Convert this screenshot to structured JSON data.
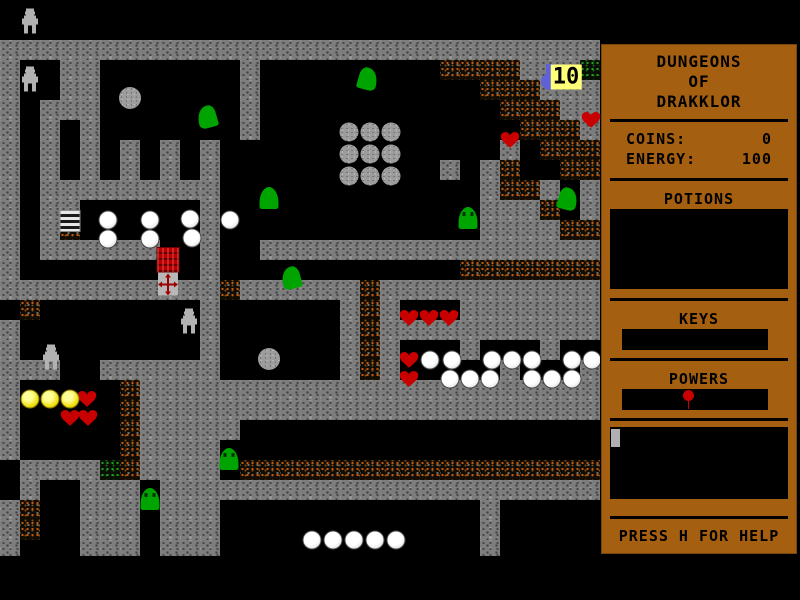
{
  "sidebar": {
    "title_lines": [
      "DUNGEONS",
      "OF",
      "DRAKKLOR"
    ],
    "coins_label": "COINS:",
    "coins_value": "0",
    "energy_label": "ENERGY:",
    "energy_value": "100",
    "potions_label": "POTIONS",
    "keys_label": "KEYS",
    "powers_label": "POWERS",
    "powers_items": [
      "red-pin"
    ],
    "help_text": "PRESS H FOR HELP"
  },
  "palette": {
    "panel_brown": "#a55f10",
    "wall_gray": "#7d7d7d",
    "rubble_orange": "#c05a10",
    "moss_green": "#1fa01f",
    "heart_red": "#c80000",
    "slime_green": "#00a400",
    "coin_yellow": "#eedc00",
    "flask_blue": "#6060d8",
    "label_yellow": "#ffff78"
  },
  "map": {
    "tile_size": 20,
    "legend": {
      "#": "wall",
      "o": "rubble",
      "g": "moss",
      ".": "floor"
    },
    "tiles": [
      "..............................",
      "..............................",
      "##############################",
      "#..##.......#.........oooo###g",
      "#..##.......#...........ooo###",
      "#.###.......#............ooo##",
      "#.#.#.......#.............ooo#",
      "#.#.#.#.#.#..............#.ooo",
      "#.#.#.#.#.#...........#.#o..oo",
      "#.#########.............#oo#.#",
      "#.##......#.............###o.#",
      "#.#o......#.............####oo",
      "#.######..#..#################",
      "#.........#............ooooooo",
      "###########o######o###########",
      ".o........#......#o#...#######",
      "#.........#......#o###########",
      "#.........#......#o#...#...#..",
      "###..######......#o#.....#...#",
      "#.....o#######################",
      "#.....o#######################",
      "#.....o#####..................",
      "#.....o####...................",
      ".####go####.oooooooooooooooooo",
      ".#..###.######################",
      "#o..###.###.............#.....",
      "#o..###.###.............#.....",
      "#...###.###.............#....."
    ],
    "items": [
      {
        "type": "robot",
        "x": 30,
        "y": 21
      },
      {
        "type": "robot",
        "x": 30,
        "y": 79
      },
      {
        "type": "robot",
        "x": 189,
        "y": 321
      },
      {
        "type": "robot",
        "x": 51,
        "y": 357
      },
      {
        "type": "ball",
        "x": 130,
        "y": 98
      },
      {
        "type": "ball",
        "x": 269,
        "y": 359
      },
      {
        "type": "ball",
        "x": 349,
        "y": 132,
        "variant": "small"
      },
      {
        "type": "ball",
        "x": 370,
        "y": 132,
        "variant": "small"
      },
      {
        "type": "ball",
        "x": 391,
        "y": 132,
        "variant": "small"
      },
      {
        "type": "ball",
        "x": 349,
        "y": 154,
        "variant": "small"
      },
      {
        "type": "ball",
        "x": 370,
        "y": 154,
        "variant": "small"
      },
      {
        "type": "ball",
        "x": 391,
        "y": 154,
        "variant": "small"
      },
      {
        "type": "ball",
        "x": 349,
        "y": 176,
        "variant": "small"
      },
      {
        "type": "ball",
        "x": 370,
        "y": 176,
        "variant": "small"
      },
      {
        "type": "ball",
        "x": 391,
        "y": 176,
        "variant": "small"
      },
      {
        "type": "slime",
        "x": 207,
        "y": 117,
        "variant": "hook-left"
      },
      {
        "type": "slime",
        "x": 368,
        "y": 79,
        "variant": "hook-right"
      },
      {
        "type": "slime",
        "x": 269,
        "y": 198,
        "variant": "bell"
      },
      {
        "type": "slime",
        "x": 468,
        "y": 218,
        "variant": "bell-eyes"
      },
      {
        "type": "slime",
        "x": 568,
        "y": 199,
        "variant": "hook-right"
      },
      {
        "type": "slime",
        "x": 291,
        "y": 278,
        "variant": "hook-left"
      },
      {
        "type": "slime",
        "x": 229,
        "y": 459,
        "variant": "bell-eyes"
      },
      {
        "type": "slime",
        "x": 150,
        "y": 499,
        "variant": "bell-eyes"
      },
      {
        "type": "orb",
        "x": 108,
        "y": 220
      },
      {
        "type": "orb",
        "x": 150,
        "y": 220
      },
      {
        "type": "orb",
        "x": 190,
        "y": 219
      },
      {
        "type": "orb",
        "x": 230,
        "y": 220
      },
      {
        "type": "orb",
        "x": 108,
        "y": 239
      },
      {
        "type": "orb",
        "x": 150,
        "y": 239
      },
      {
        "type": "orb",
        "x": 192,
        "y": 238
      },
      {
        "type": "orb",
        "x": 430,
        "y": 360
      },
      {
        "type": "orb",
        "x": 452,
        "y": 360
      },
      {
        "type": "orb",
        "x": 492,
        "y": 360
      },
      {
        "type": "orb",
        "x": 512,
        "y": 360
      },
      {
        "type": "orb",
        "x": 532,
        "y": 360
      },
      {
        "type": "orb",
        "x": 572,
        "y": 360
      },
      {
        "type": "orb",
        "x": 592,
        "y": 360
      },
      {
        "type": "orb",
        "x": 450,
        "y": 379
      },
      {
        "type": "orb",
        "x": 470,
        "y": 379
      },
      {
        "type": "orb",
        "x": 490,
        "y": 379
      },
      {
        "type": "orb",
        "x": 532,
        "y": 379
      },
      {
        "type": "orb",
        "x": 552,
        "y": 379
      },
      {
        "type": "orb",
        "x": 572,
        "y": 379
      },
      {
        "type": "orb",
        "x": 312,
        "y": 540
      },
      {
        "type": "orb",
        "x": 333,
        "y": 540
      },
      {
        "type": "orb",
        "x": 354,
        "y": 540
      },
      {
        "type": "orb",
        "x": 375,
        "y": 540
      },
      {
        "type": "orb",
        "x": 396,
        "y": 540
      },
      {
        "type": "heart",
        "x": 591,
        "y": 120
      },
      {
        "type": "heart",
        "x": 510,
        "y": 140
      },
      {
        "type": "heart",
        "x": 409,
        "y": 318
      },
      {
        "type": "heart",
        "x": 429,
        "y": 318
      },
      {
        "type": "heart",
        "x": 449,
        "y": 318
      },
      {
        "type": "heart",
        "x": 409,
        "y": 360
      },
      {
        "type": "heart",
        "x": 409,
        "y": 379
      },
      {
        "type": "heart",
        "x": 87,
        "y": 399
      },
      {
        "type": "heart",
        "x": 70,
        "y": 418
      },
      {
        "type": "heart",
        "x": 88,
        "y": 418
      },
      {
        "type": "coin",
        "x": 30,
        "y": 399
      },
      {
        "type": "coin",
        "x": 50,
        "y": 399
      },
      {
        "type": "coin",
        "x": 70,
        "y": 399
      },
      {
        "type": "ladder",
        "x": 70,
        "y": 221
      },
      {
        "type": "chest",
        "x": 168,
        "y": 260
      },
      {
        "type": "cross",
        "x": 168,
        "y": 284
      },
      {
        "type": "flask",
        "x": 551,
        "y": 78
      },
      {
        "type": "label",
        "x": 566,
        "y": 77,
        "text": "10"
      }
    ]
  }
}
